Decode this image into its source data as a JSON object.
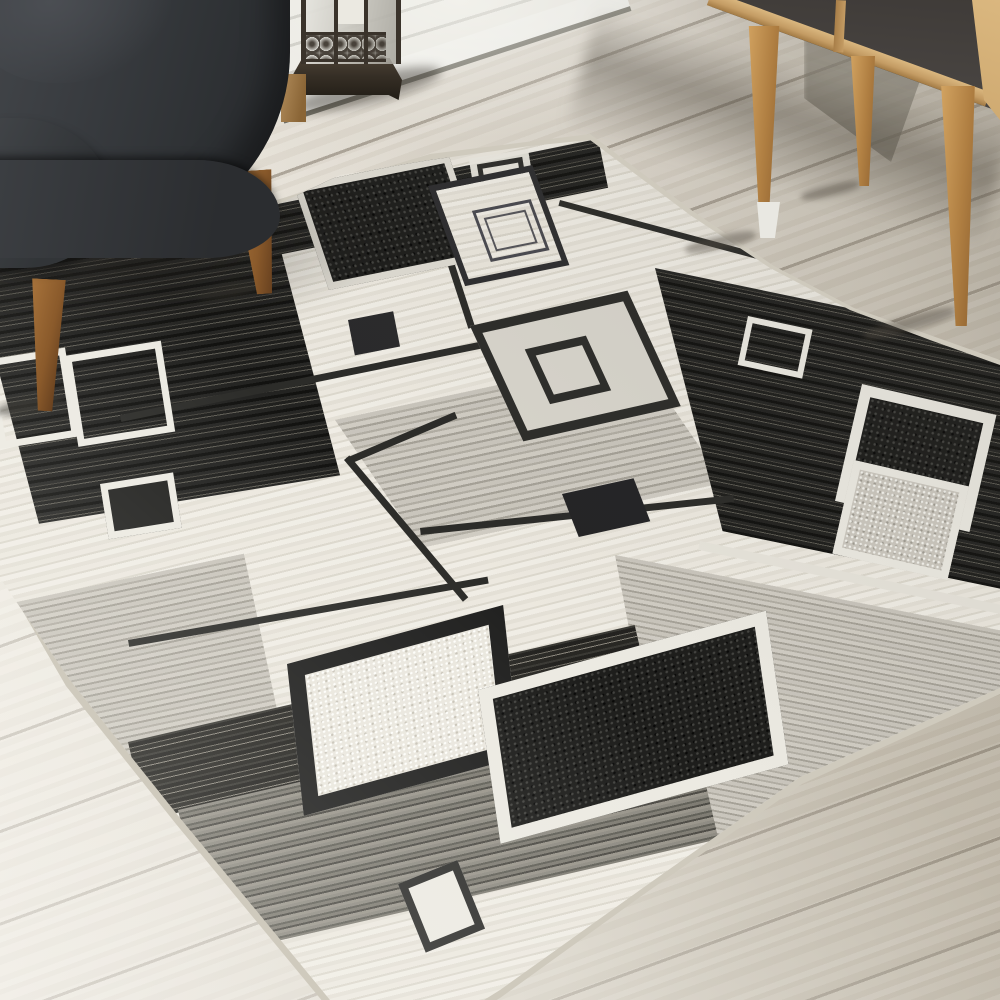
{
  "scene": {
    "description": "Photograph of a living room corner: a black, white and gray geometric squares area rug lies diagonally on a whitewashed wood plank floor; a dark charcoal fabric armchair with tapered wooden legs sits at the top left, a bronze candle lantern with a white pillar candle stands behind it against a white shiplap wall, and a mid-century oak sideboard with dark slate door panels and splayed wooden legs stands at the top right.",
    "objects": {
      "rug": {
        "label": "geometric area rug",
        "pattern": "overlapping squares and grid lines in black, charcoal, gray and cream"
      },
      "armchair": {
        "label": "charcoal fabric armchair with wooden legs"
      },
      "lantern": {
        "label": "bronze candle lantern with white pillar candle"
      },
      "sideboard": {
        "label": "oak sideboard with dark slate panels and splayed tapered legs"
      },
      "floor": {
        "label": "whitewashed diagonal wood plank floor"
      },
      "wall": {
        "label": "white shiplap wall with baseboard"
      }
    }
  },
  "colors": {
    "floor-base": "#dcd6cb",
    "floor-light": "#f0ece3",
    "floor-dark": "#c3bcae",
    "wall-board": "#f0efe9",
    "wall-seam": "#cdccc5",
    "baseboard": "#f5f5f1",
    "baseboard-gap": "#706e64",
    "chair-fabric": "#393c40",
    "chair-fabric-dark": "#26282b",
    "chair-leg": "#8a5a2b",
    "chair-leg-light": "#a5713a",
    "chair-leg-dark": "#5e3a1c",
    "oak": "#c49c64",
    "oak-light": "#dab77f",
    "slate": "#4b4744",
    "lantern-metal": "#3a332b",
    "candle": "#ebe9e1",
    "rug-cream": "#e7e4db",
    "rug-white": "#eceae2",
    "rug-gray": "#c4c0b7",
    "rug-midgray": "#a9a59b",
    "rug-dark": "#232321",
    "rug-black": "#1c1c1a",
    "rug-line": "#2c2c29"
  }
}
